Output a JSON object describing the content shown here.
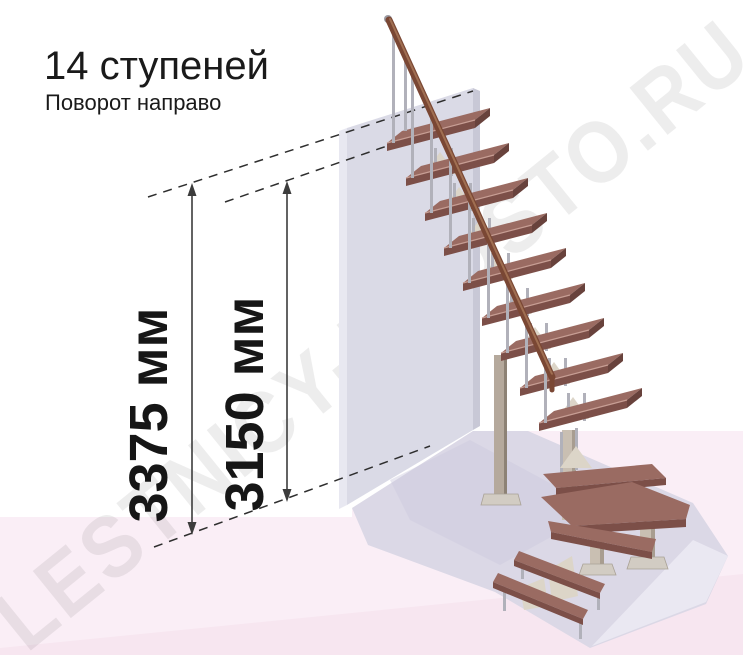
{
  "header": {
    "title": "14 ступеней",
    "subtitle": "Поворот направо"
  },
  "watermark": "LESTNICY-PROSTO.RU",
  "dimensions": [
    {
      "name": "total-rise",
      "label": "3375 мм"
    },
    {
      "name": "floor-to-top-step",
      "label": "3150 мм"
    }
  ],
  "stair": {
    "step_count": "14",
    "turn_direction": "направо"
  },
  "colors": {
    "tread_wood": "#9a6b62",
    "handrail_wood": "#7a4734",
    "wall_gray": "#dadae6",
    "floor_pink": "#faeef6",
    "platform_lavender": "#dbd8e6",
    "metal_gray": "#b1b1ba",
    "support_cream": "#dcd5c8",
    "dimension_line": "#3c3c3c",
    "watermark_gray": "#ececec"
  }
}
